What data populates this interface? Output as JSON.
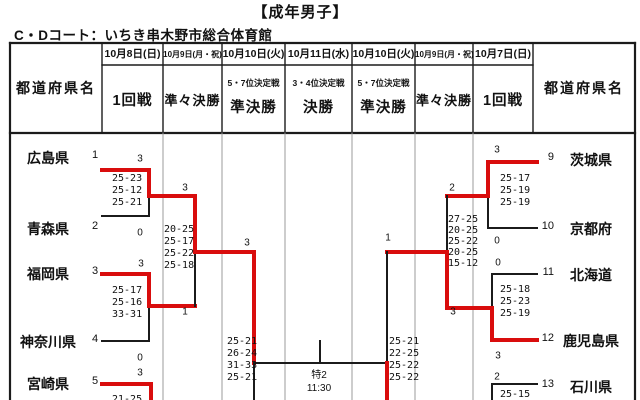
{
  "page": {
    "title": "【成年男子】",
    "venue": "C・Dコート：いちき串木野市総合体育館"
  },
  "colors": {
    "winner_path": "#d90d0d",
    "line": "#1b1b1b",
    "grid_faint": "#9b9b9b"
  },
  "table": {
    "prefecture_header": "都道府県名",
    "columns": [
      {
        "date": "10月8日(日)",
        "round": "1回戦",
        "sub": ""
      },
      {
        "date": "10月9日(月・祝)",
        "round": "準々決勝",
        "sub": ""
      },
      {
        "date": "10月10日(火)",
        "round": "準決勝",
        "sub": "5・7位決定戦"
      },
      {
        "date": "10月11日(水)",
        "round": "決勝",
        "sub": "3・4位決定戦"
      },
      {
        "date": "10月10日(火)",
        "round": "準決勝",
        "sub": "5・7位決定戦"
      },
      {
        "date": "10月9日(月・祝)",
        "round": "準々決勝",
        "sub": ""
      },
      {
        "date": "10月7日(日)",
        "round": "1回戦",
        "sub": ""
      }
    ]
  },
  "final": {
    "court": "特2",
    "time": "11:30"
  },
  "bracket": {
    "left_teams": [
      {
        "name": "広島県",
        "seed": "1",
        "y": 157,
        "winner": true
      },
      {
        "name": "青森県",
        "seed": "2",
        "y": 228,
        "winner": false
      },
      {
        "name": "福岡県",
        "seed": "3",
        "y": 273,
        "winner": true
      },
      {
        "name": "神奈川県",
        "seed": "4",
        "y": 341,
        "winner": false
      },
      {
        "name": "宮崎県",
        "seed": "5",
        "y": 383,
        "winner": true
      }
    ],
    "right_teams": [
      {
        "name": "茨城県",
        "seed": "9",
        "y": 159,
        "winner": true
      },
      {
        "name": "京都府",
        "seed": "10",
        "y": 228,
        "winner": false
      },
      {
        "name": "北海道",
        "seed": "11",
        "y": 274,
        "winner": false
      },
      {
        "name": "鹿児島県",
        "seed": "12",
        "y": 340,
        "winner": true
      },
      {
        "name": "石川県",
        "seed": "13",
        "y": 386,
        "winner": false
      }
    ],
    "set_scores": [
      {
        "x": 112,
        "y": 173,
        "lh": 12,
        "lines": [
          "25-23",
          "25-12",
          "25-21"
        ]
      },
      {
        "x": 112,
        "y": 285,
        "lh": 12,
        "lines": [
          "25-17",
          "25-16",
          "33-31"
        ]
      },
      {
        "x": 164,
        "y": 224,
        "lh": 12,
        "lines": [
          "20-25",
          "25-17",
          "25-22",
          "25-18"
        ]
      },
      {
        "x": 227,
        "y": 336,
        "lh": 12,
        "lines": [
          "25-21",
          "26-24",
          "31-33",
          "25-21"
        ]
      },
      {
        "x": 112,
        "y": 394,
        "lh": 12,
        "lines": [
          "21-25"
        ]
      },
      {
        "x": 500,
        "y": 173,
        "lh": 12,
        "lines": [
          "25-17",
          "25-19",
          "25-19"
        ]
      },
      {
        "x": 500,
        "y": 284,
        "lh": 12,
        "lines": [
          "25-18",
          "25-23",
          "25-19"
        ]
      },
      {
        "x": 448,
        "y": 214,
        "lh": 11,
        "lines": [
          "27-25",
          "20-25",
          "25-22",
          "20-25",
          "15-12"
        ]
      },
      {
        "x": 389,
        "y": 336,
        "lh": 12,
        "lines": [
          "25-21",
          "22-25",
          "25-22",
          "25-22"
        ]
      },
      {
        "x": 500,
        "y": 389,
        "lh": 12,
        "lines": [
          "25-15"
        ]
      }
    ],
    "set_count_labels": [
      {
        "x": 140,
        "y": 159,
        "v": "3"
      },
      {
        "x": 140,
        "y": 233,
        "v": "0"
      },
      {
        "x": 141,
        "y": 264,
        "v": "3"
      },
      {
        "x": 140,
        "y": 358,
        "v": "0"
      },
      {
        "x": 140,
        "y": 373,
        "v": "3"
      },
      {
        "x": 185,
        "y": 188,
        "v": "3"
      },
      {
        "x": 185,
        "y": 312,
        "v": "1"
      },
      {
        "x": 247,
        "y": 243,
        "v": "3"
      },
      {
        "x": 497,
        "y": 150,
        "v": "3"
      },
      {
        "x": 497,
        "y": 241,
        "v": "0"
      },
      {
        "x": 498,
        "y": 263,
        "v": "0"
      },
      {
        "x": 498,
        "y": 356,
        "v": "3"
      },
      {
        "x": 497,
        "y": 377,
        "v": "2"
      },
      {
        "x": 452,
        "y": 188,
        "v": "2"
      },
      {
        "x": 453,
        "y": 312,
        "v": "3"
      },
      {
        "x": 388,
        "y": 238,
        "v": "1"
      }
    ],
    "lines": [
      {
        "x1": 102,
        "y1": 170,
        "x2": 149,
        "y2": 170,
        "win": true
      },
      {
        "x1": 149,
        "y1": 170,
        "x2": 149,
        "y2": 196,
        "win": true
      },
      {
        "x1": 149,
        "y1": 196,
        "x2": 149,
        "y2": 216,
        "win": false
      },
      {
        "x1": 102,
        "y1": 216,
        "x2": 149,
        "y2": 216,
        "win": false
      },
      {
        "x1": 149,
        "y1": 196,
        "x2": 195,
        "y2": 196,
        "win": true
      },
      {
        "x1": 102,
        "y1": 274,
        "x2": 149,
        "y2": 274,
        "win": true
      },
      {
        "x1": 149,
        "y1": 274,
        "x2": 149,
        "y2": 306,
        "win": true
      },
      {
        "x1": 149,
        "y1": 306,
        "x2": 149,
        "y2": 341,
        "win": false
      },
      {
        "x1": 102,
        "y1": 341,
        "x2": 149,
        "y2": 341,
        "win": false
      },
      {
        "x1": 149,
        "y1": 306,
        "x2": 195,
        "y2": 306,
        "win": true
      },
      {
        "x1": 195,
        "y1": 196,
        "x2": 195,
        "y2": 252,
        "win": true
      },
      {
        "x1": 195,
        "y1": 252,
        "x2": 195,
        "y2": 306,
        "win": false
      },
      {
        "x1": 195,
        "y1": 252,
        "x2": 254,
        "y2": 252,
        "win": true
      },
      {
        "x1": 254,
        "y1": 252,
        "x2": 254,
        "y2": 363,
        "win": true
      },
      {
        "x1": 254,
        "y1": 363,
        "x2": 254,
        "y2": 402,
        "win": false
      },
      {
        "x1": 102,
        "y1": 384,
        "x2": 151,
        "y2": 384,
        "win": true
      },
      {
        "x1": 151,
        "y1": 384,
        "x2": 151,
        "y2": 402,
        "win": true
      },
      {
        "x1": 254,
        "y1": 363,
        "x2": 387,
        "y2": 363,
        "win": false
      },
      {
        "x1": 320,
        "y1": 341,
        "x2": 320,
        "y2": 363,
        "win": false
      },
      {
        "x1": 488,
        "y1": 162,
        "x2": 537,
        "y2": 162,
        "win": true
      },
      {
        "x1": 488,
        "y1": 162,
        "x2": 488,
        "y2": 196,
        "win": true
      },
      {
        "x1": 488,
        "y1": 196,
        "x2": 488,
        "y2": 228,
        "win": false
      },
      {
        "x1": 488,
        "y1": 228,
        "x2": 537,
        "y2": 228,
        "win": false
      },
      {
        "x1": 447,
        "y1": 196,
        "x2": 488,
        "y2": 196,
        "win": true
      },
      {
        "x1": 492,
        "y1": 274,
        "x2": 537,
        "y2": 274,
        "win": false
      },
      {
        "x1": 492,
        "y1": 274,
        "x2": 492,
        "y2": 308,
        "win": false
      },
      {
        "x1": 492,
        "y1": 308,
        "x2": 492,
        "y2": 340,
        "win": true
      },
      {
        "x1": 492,
        "y1": 340,
        "x2": 537,
        "y2": 340,
        "win": true
      },
      {
        "x1": 447,
        "y1": 308,
        "x2": 492,
        "y2": 308,
        "win": true
      },
      {
        "x1": 447,
        "y1": 196,
        "x2": 447,
        "y2": 252,
        "win": false
      },
      {
        "x1": 447,
        "y1": 252,
        "x2": 447,
        "y2": 308,
        "win": true
      },
      {
        "x1": 387,
        "y1": 252,
        "x2": 447,
        "y2": 252,
        "win": true
      },
      {
        "x1": 387,
        "y1": 252,
        "x2": 387,
        "y2": 363,
        "win": false
      },
      {
        "x1": 387,
        "y1": 363,
        "x2": 387,
        "y2": 402,
        "win": true
      },
      {
        "x1": 492,
        "y1": 384,
        "x2": 537,
        "y2": 384,
        "win": false
      },
      {
        "x1": 492,
        "y1": 384,
        "x2": 492,
        "y2": 402,
        "win": false
      }
    ]
  },
  "geometry": {
    "grid": [
      {
        "x1": 10,
        "y1": 43,
        "x2": 635,
        "y2": 43,
        "t": "outer"
      },
      {
        "x1": 10,
        "y1": 43,
        "x2": 10,
        "y2": 400,
        "t": "outer"
      },
      {
        "x1": 635,
        "y1": 43,
        "x2": 635,
        "y2": 400,
        "t": "outer"
      },
      {
        "x1": 10,
        "y1": 133,
        "x2": 635,
        "y2": 133,
        "t": "outer"
      },
      {
        "x1": 102,
        "y1": 65,
        "x2": 533,
        "y2": 65,
        "t": "head"
      },
      {
        "x1": 102,
        "y1": 43,
        "x2": 102,
        "y2": 133,
        "t": "head"
      },
      {
        "x1": 163,
        "y1": 43,
        "x2": 163,
        "y2": 133,
        "t": "head"
      },
      {
        "x1": 222,
        "y1": 43,
        "x2": 222,
        "y2": 133,
        "t": "head"
      },
      {
        "x1": 285,
        "y1": 43,
        "x2": 285,
        "y2": 133,
        "t": "head"
      },
      {
        "x1": 352,
        "y1": 43,
        "x2": 352,
        "y2": 133,
        "t": "head"
      },
      {
        "x1": 415,
        "y1": 43,
        "x2": 415,
        "y2": 133,
        "t": "head"
      },
      {
        "x1": 473,
        "y1": 43,
        "x2": 473,
        "y2": 133,
        "t": "head"
      },
      {
        "x1": 533,
        "y1": 43,
        "x2": 533,
        "y2": 133,
        "t": "head"
      },
      {
        "x1": 163,
        "y1": 133,
        "x2": 163,
        "y2": 400,
        "t": "body"
      },
      {
        "x1": 222,
        "y1": 133,
        "x2": 222,
        "y2": 400,
        "t": "body"
      },
      {
        "x1": 285,
        "y1": 133,
        "x2": 285,
        "y2": 400,
        "t": "body"
      },
      {
        "x1": 352,
        "y1": 133,
        "x2": 352,
        "y2": 400,
        "t": "body"
      },
      {
        "x1": 415,
        "y1": 133,
        "x2": 415,
        "y2": 400,
        "t": "body"
      },
      {
        "x1": 473,
        "y1": 133,
        "x2": 473,
        "y2": 400,
        "t": "body"
      }
    ]
  }
}
